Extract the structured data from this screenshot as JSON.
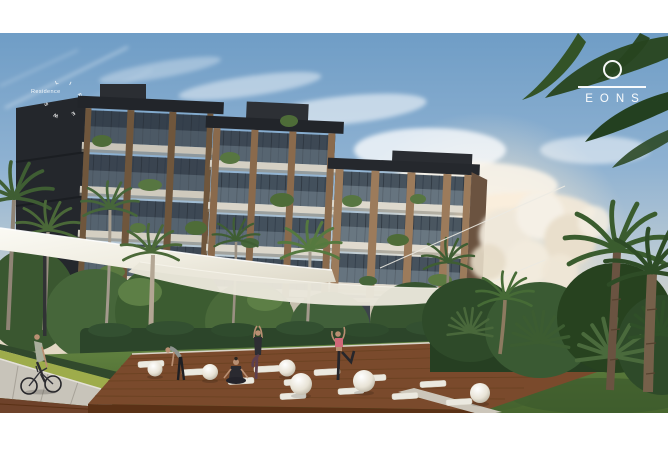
{
  "photo": {
    "alt": "Architectural rendering of a modern residential building with palm trees, a white tensile shade canopy and an outdoor wooden yoga deck where four women exercise; a cyclist rides a path at the left",
    "frame_color": "#ffffff"
  },
  "brand": {
    "name": "EONS",
    "icon": "ring-icon",
    "text_color": "#ffffff"
  },
  "residence_mark": {
    "label": "Residence",
    "circular_letters": [
      "L",
      "I",
      "F",
      "E",
      "W",
      "S"
    ]
  },
  "palette": {
    "sky_top": "#6f9dc6",
    "sky_horizon": "#ecdfc8",
    "building_frame": "#3d4854",
    "building_wood": "#8a6a4c",
    "slab_light": "#d9d4c8",
    "canopy_white": "#f2efe6",
    "foliage_green": "#46663a",
    "deck_brown": "#7a4a2c",
    "lawn_green": "#5d7e3e",
    "accent_pink": "#d06878"
  }
}
